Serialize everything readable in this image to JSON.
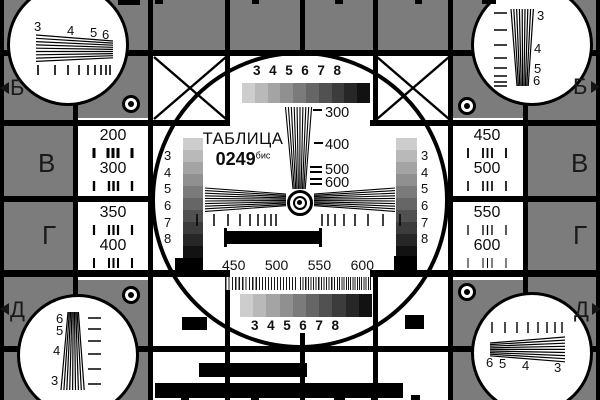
{
  "card": {
    "title": "ТАБЛИЦА",
    "code": "0249",
    "code_suffix": "бис",
    "colors": {
      "background_gray": "#7c7c7c",
      "white": "#ffffff",
      "black": "#000000",
      "text_dark": "#1a1a1a"
    },
    "grayscale_steps": [
      "#cdcdcd",
      "#b9b9b9",
      "#a4a4a4",
      "#909090",
      "#7b7b7b",
      "#666666",
      "#515151",
      "#3c3c3c",
      "#272727",
      "#121212"
    ],
    "center_circle": {
      "top_resolution_scale": [
        "3",
        "4",
        "5",
        "6",
        "7",
        "8"
      ],
      "bottom_resolution_scale": [
        "3",
        "4",
        "5",
        "6",
        "7",
        "8"
      ],
      "left_gray_scale": [
        "3",
        "4",
        "5",
        "6",
        "7",
        "8"
      ],
      "right_gray_scale": [
        "3",
        "4",
        "5",
        "6",
        "7",
        "8"
      ],
      "vertical_wedge_labels": [
        "300",
        "400",
        "500",
        "600"
      ],
      "burst_frequency_labels": [
        "450",
        "500",
        "550",
        "600"
      ]
    },
    "left_panels": [
      "200",
      "300",
      "350",
      "400"
    ],
    "right_panels": [
      "450",
      "500",
      "550",
      "600"
    ],
    "edge_letters_left": [
      "Б",
      "В",
      "Г",
      "Д"
    ],
    "edge_letters_right": [
      "Б",
      "В",
      "Г",
      "Д"
    ],
    "corner_wedge_scales": {
      "top_left": [
        "3",
        "4",
        "5",
        "6"
      ],
      "top_right": [
        "3",
        "4",
        "5",
        "6"
      ],
      "bottom_left": [
        "6",
        "5",
        "4",
        "3"
      ],
      "bottom_right": [
        "6",
        "5",
        "4",
        "3"
      ]
    }
  }
}
